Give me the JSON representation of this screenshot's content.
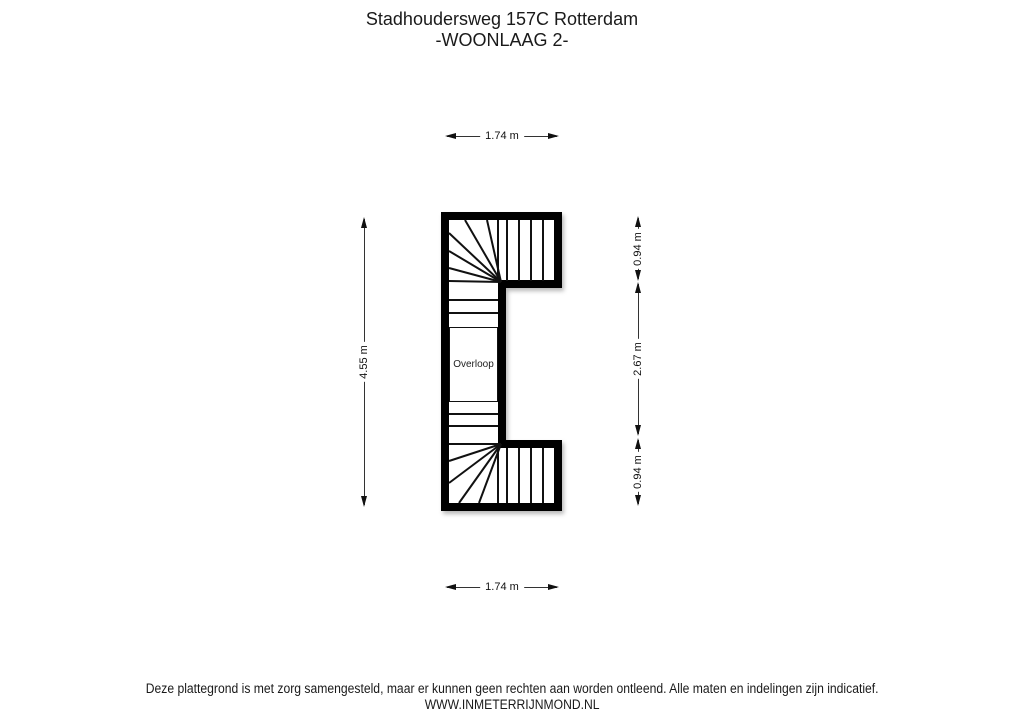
{
  "title": {
    "line1": "Stadhoudersweg 157C Rotterdam",
    "line2": "-WOONLAAG 2-"
  },
  "floorplan": {
    "room_label": "Overloop",
    "dimensions": {
      "top": "1.74 m",
      "bottom": "1.74 m",
      "left": "4.55 m",
      "right_top": "0.94 m",
      "right_middle": "2.67 m",
      "right_bottom": "0.94 m"
    },
    "colors": {
      "wall": "#000000",
      "stair_line": "#111111",
      "landing_fill": "#f8eec6",
      "background": "#ffffff"
    }
  },
  "footer": {
    "disclaimer": "Deze plattegrond is met zorg samengesteld, maar er kunnen geen rechten aan worden ontleend. Alle maten en indelingen zijn indicatief.",
    "website": "WWW.INMETERRIJNMOND.NL"
  }
}
